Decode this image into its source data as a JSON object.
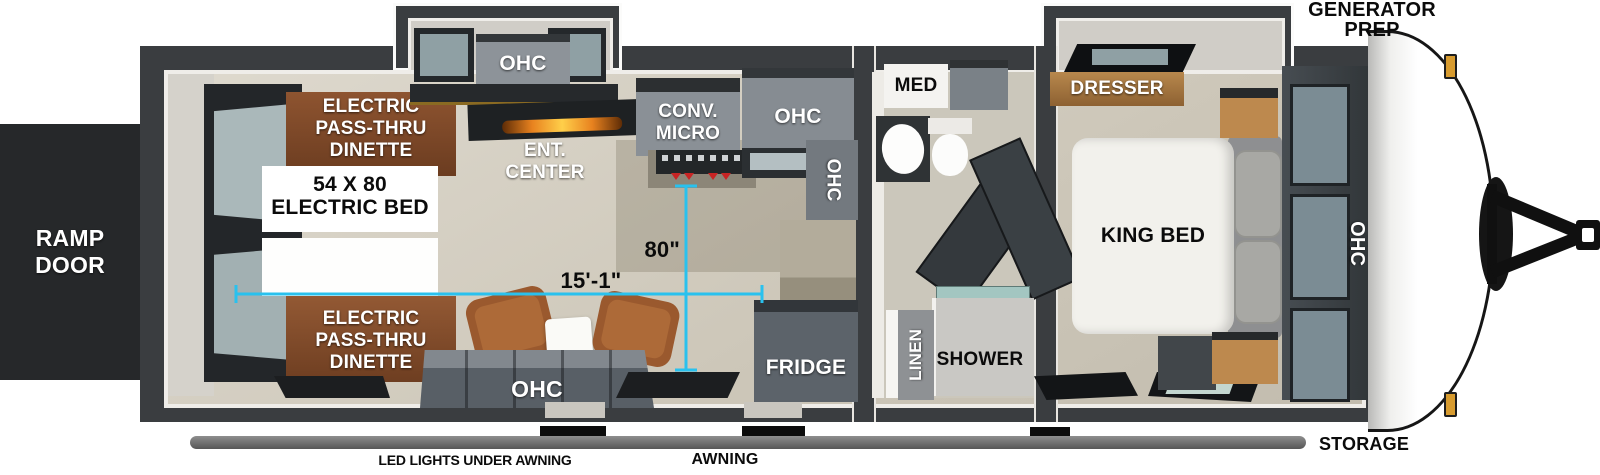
{
  "palette": {
    "dimension_accent": "#29c1ee",
    "wall_dark": "#3a3d40",
    "floor_beige": "#d5cfc2",
    "cabinet_gray": "#878d93",
    "dinette_brown": "#8a5130",
    "awning_gray": "#6e6e6e"
  },
  "exterior": {
    "ramp_door_lines": [
      "RAMP",
      "DOOR"
    ],
    "generator_prep_lines": [
      "GENERATOR",
      "PREP"
    ],
    "storage_label": "STORAGE",
    "awning_label": "AWNING",
    "led_lights_label": "LED LIGHTS UNDER AWNING"
  },
  "living_area": {
    "dinette_top_lines": [
      "ELECTRIC",
      "PASS-THRU",
      "DINETTE"
    ],
    "electric_bed_lines": [
      "54 X 80",
      "ELECTRIC BED"
    ],
    "dinette_bottom_lines": [
      "ELECTRIC",
      "PASS-THRU",
      "DINETTE"
    ],
    "ent_center_lines": [
      "ENT.",
      "CENTER"
    ],
    "slide_ohc_label": "OHC",
    "bottom_ohc_label": "OHC"
  },
  "kitchen": {
    "conv_micro_lines": [
      "CONV.",
      "MICRO"
    ],
    "upper_ohc_label": "OHC",
    "side_ohc_label": "OHC",
    "fridge_label": "FRIDGE"
  },
  "bathroom": {
    "med_label": "MED",
    "linen_label": "LINEN",
    "shower_label": "SHOWER"
  },
  "bedroom": {
    "dresser_label": "DRESSER",
    "king_bed_label": "KING BED",
    "front_ohc_label": "OHC"
  },
  "dimensions": {
    "slide_depth": "80\"",
    "cargo_length": "15'-1\""
  }
}
